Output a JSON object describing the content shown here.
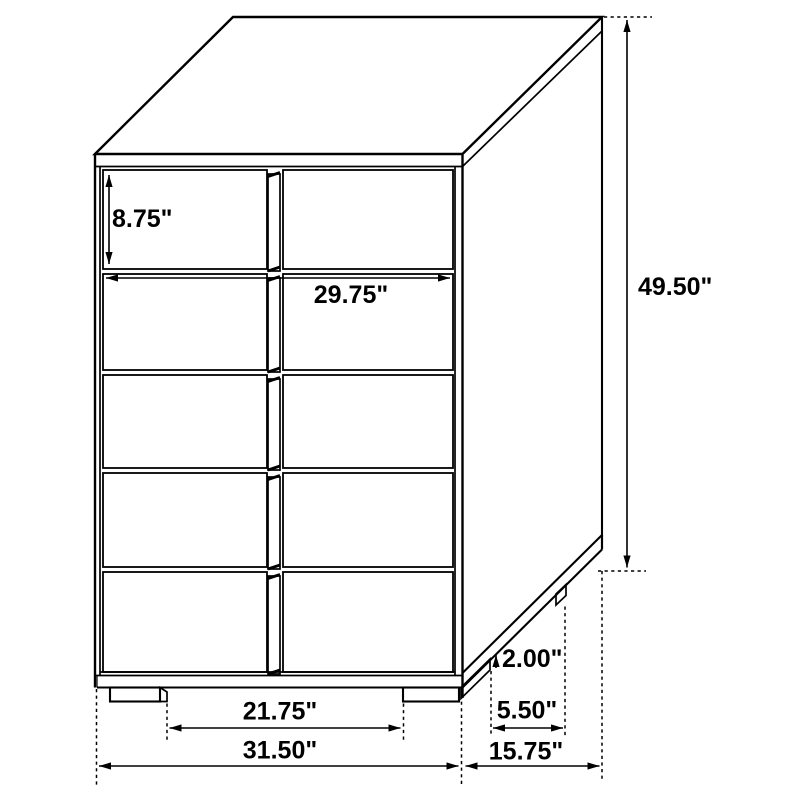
{
  "diagram": {
    "type": "furniture dimension line drawing",
    "subject": "five-drawer chest, three-quarter view",
    "background_color": "#ffffff",
    "line_color": "#000000",
    "unit": "inches",
    "labels": {
      "drawer_height": "8.75\"",
      "drawer_width": "29.75\"",
      "overall_height": "49.50\"",
      "base_height": "2.00\"",
      "side_foot_inset": "5.50\"",
      "front_foot_span": "21.75\"",
      "overall_width": "31.50\"",
      "overall_depth": "15.75\""
    }
  }
}
